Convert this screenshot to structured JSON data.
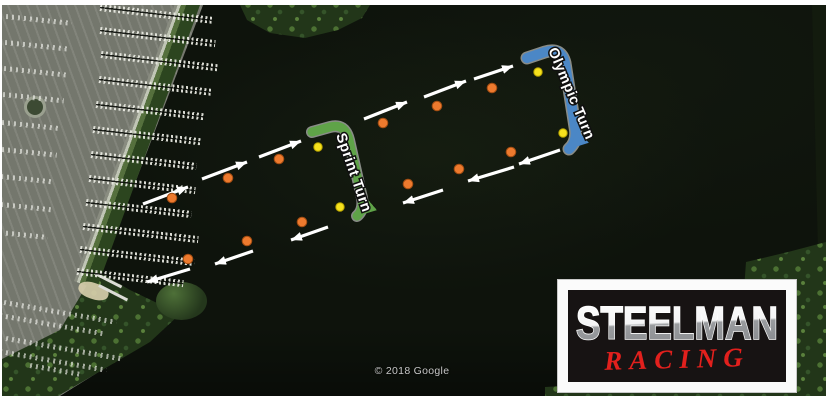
{
  "attribution": "© 2018 Google",
  "logo": {
    "line1": "STEELMAN",
    "line2": "RACING",
    "steel_light": "#ffffff",
    "steel_dark": "#95979a",
    "racing_color": "#e2201d"
  },
  "course": {
    "arrow_color": "#ffffff",
    "buoy_colors": {
      "orange": "#ed7a2e",
      "yellow": "#f6e11d"
    },
    "orange_buoys": [
      [
        172,
        198
      ],
      [
        228,
        178
      ],
      [
        279,
        159
      ],
      [
        383,
        123
      ],
      [
        437,
        106
      ],
      [
        492,
        88
      ],
      [
        511,
        152
      ],
      [
        459,
        169
      ],
      [
        408,
        184
      ],
      [
        302,
        222
      ],
      [
        247,
        241
      ],
      [
        188,
        259
      ]
    ],
    "yellow_buoys": [
      [
        318,
        147
      ],
      [
        340,
        207
      ],
      [
        538,
        72
      ],
      [
        563,
        133
      ]
    ],
    "arrows": [
      {
        "from": [
          143,
          204
        ],
        "to": [
          188,
          187
        ]
      },
      {
        "from": [
          202,
          179
        ],
        "to": [
          247,
          162
        ]
      },
      {
        "from": [
          259,
          157
        ],
        "to": [
          301,
          141
        ]
      },
      {
        "from": [
          364,
          119
        ],
        "to": [
          407,
          102
        ]
      },
      {
        "from": [
          424,
          97
        ],
        "to": [
          466,
          81
        ]
      },
      {
        "from": [
          474,
          79
        ],
        "to": [
          513,
          66
        ]
      },
      {
        "from": [
          560,
          150
        ],
        "to": [
          519,
          164
        ]
      },
      {
        "from": [
          514,
          167
        ],
        "to": [
          468,
          181
        ]
      },
      {
        "from": [
          443,
          190
        ],
        "to": [
          403,
          203
        ]
      },
      {
        "from": [
          328,
          227
        ],
        "to": [
          291,
          240
        ]
      },
      {
        "from": [
          253,
          251
        ],
        "to": [
          215,
          264
        ]
      },
      {
        "from": [
          190,
          269
        ],
        "to": [
          147,
          282
        ]
      }
    ],
    "turns": [
      {
        "label": "Sprint Turn",
        "color": "#5fa348",
        "width": 9,
        "path": "M 312 132 L 330 127 Q 345 123 349 140 L 362 198 Q 364 210 357 216",
        "label_pos": [
          336,
          135
        ],
        "label_rotation": 71
      },
      {
        "label": "Olympic Turn",
        "color": "#4b87c6",
        "width": 10,
        "path": "M 527 58 L 545 52 Q 561 47 565 63 L 575 127 Q 578 141 569 149",
        "label_pos": [
          548,
          50
        ],
        "label_rotation": 67
      }
    ]
  },
  "marina": {
    "piers": [
      [
        4,
        100,
        213
      ],
      [
        27,
        100,
        216
      ],
      [
        51,
        101,
        218
      ],
      [
        76,
        99,
        212
      ],
      [
        101,
        96,
        206
      ],
      [
        126,
        93,
        201
      ],
      [
        151,
        91,
        197
      ],
      [
        175,
        89,
        196
      ],
      [
        199,
        86,
        192
      ],
      [
        223,
        83,
        199
      ],
      [
        246,
        80,
        195
      ],
      [
        268,
        77,
        184
      ]
    ]
  },
  "parking": {
    "car_rows": [
      [
        14,
        6,
        72,
        6
      ],
      [
        40,
        5,
        70,
        6
      ],
      [
        66,
        4,
        68,
        6
      ],
      [
        92,
        3,
        64,
        6
      ],
      [
        120,
        2,
        60,
        6
      ],
      [
        147,
        2,
        57,
        6
      ],
      [
        174,
        1,
        54,
        6
      ],
      [
        202,
        1,
        51,
        6
      ],
      [
        230,
        0,
        48,
        6
      ],
      [
        300,
        4,
        118,
        10
      ],
      [
        313,
        0,
        104,
        10
      ],
      [
        336,
        6,
        122,
        10
      ],
      [
        349,
        0,
        108,
        10
      ],
      [
        363,
        30,
        80,
        10
      ]
    ]
  }
}
